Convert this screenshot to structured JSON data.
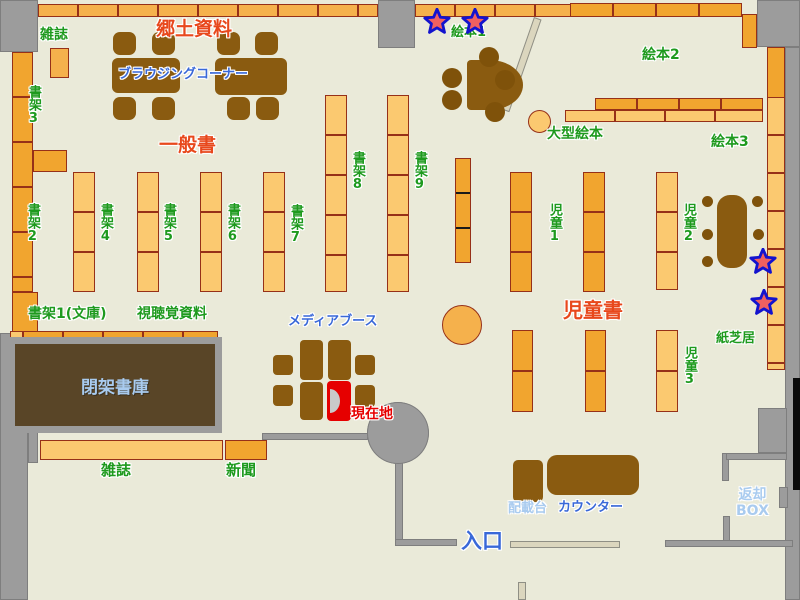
{
  "headings": {
    "local_materials": "郷土資料",
    "general_books": "一般書",
    "children_books": "児童書"
  },
  "shelf_labels": {
    "magazines_top": "雑誌",
    "shelf_2": "書架2",
    "shelf_3": "書架3",
    "shelf_4": "書架4",
    "shelf_5": "書架5",
    "shelf_6": "書架6",
    "shelf_7": "書架7",
    "shelf_8": "書架8",
    "shelf_9": "書架9",
    "shelf_1_bunko": "書架1(文庫)",
    "audiovisual": "視聴覚資料",
    "picture_book_1": "絵本1",
    "picture_book_2": "絵本2",
    "picture_book_3": "絵本3",
    "large_picture_book": "大型絵本",
    "children_1": "児童1",
    "children_2": "児童2",
    "children_3": "児童3",
    "kamishibai": "紙芝居",
    "magazines_bottom": "雑誌",
    "newspapers": "新聞"
  },
  "facility_labels": {
    "browsing_corner": "ブラウジングコーナー",
    "media_booth": "メディアブース",
    "closed_stacks": "閉架書庫",
    "current_location": "現在地",
    "entrance": "入口",
    "counter": "カウンター",
    "sorting_table": "配載台",
    "return_box_line1": "返却",
    "return_box_line2": "BOX"
  },
  "icons": {
    "star_marker": "star"
  },
  "colors": {
    "floor": "#EAEAD9",
    "wall_gray": "#9C9C9C",
    "shelf_light": "#FBC970",
    "shelf_mid": "#F5B14C",
    "shelf_dark": "#F1A52F",
    "furniture_brown": "#8A5B10",
    "closed_stacks_brown": "#594527",
    "label_green": "#1E9A1E",
    "label_red": "#E8481C",
    "label_blue": "#3968D8",
    "label_light_blue": "#A9CBEF",
    "current_location_red": "#E60000",
    "star_fill": "#F06060",
    "star_outline": "#1313CE"
  }
}
